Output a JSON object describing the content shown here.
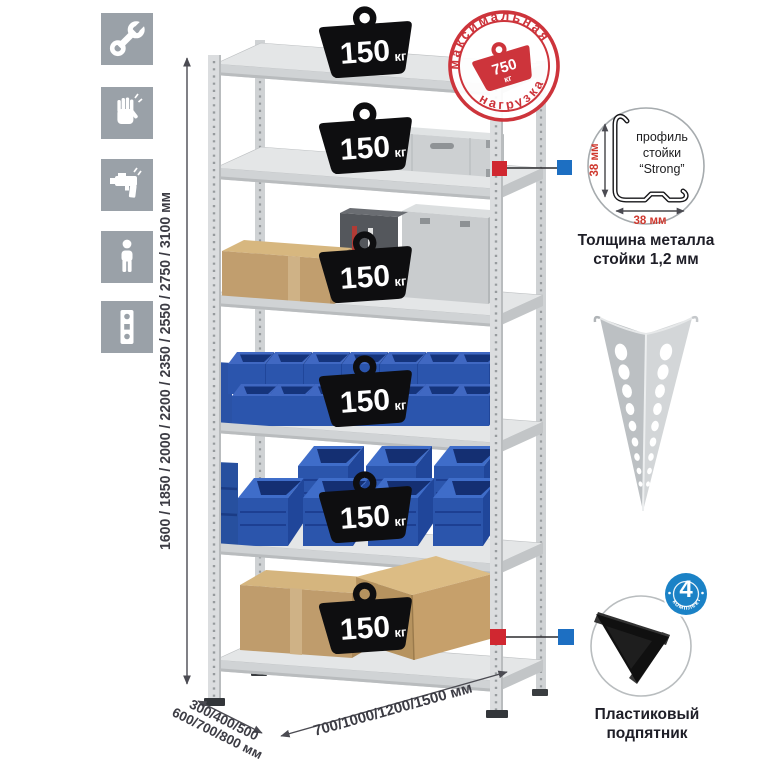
{
  "icons": [
    {
      "name": "wrench-icon"
    },
    {
      "name": "gloves-icon"
    },
    {
      "name": "drill-icon"
    },
    {
      "name": "person-icon"
    },
    {
      "name": "perforated-post-icon"
    }
  ],
  "dimensions": {
    "height": "1600 / 1850 / 2000 / 2200 / 2350 / 2550 / 2750 / 3100 мм",
    "depth_line1": "300/400/500",
    "depth_line2": "600/700/800 мм",
    "width": "700/1000/1200/1500 мм"
  },
  "stamp": {
    "arc_top": "максимальная",
    "arc_bottom": "нагрузка",
    "value": "750",
    "unit": "кг"
  },
  "rack": {
    "shelves": [
      {
        "load": "150",
        "unit": "кг"
      },
      {
        "load": "150",
        "unit": "кг"
      },
      {
        "load": "150",
        "unit": "кг"
      },
      {
        "load": "150",
        "unit": "кг"
      },
      {
        "load": "150",
        "unit": "кг"
      },
      {
        "load": "150",
        "unit": "кг"
      }
    ]
  },
  "profile_detail": {
    "line1": "профиль",
    "line2": "стойки",
    "line3": "“Strong”",
    "vertical_dim": "38 мм",
    "horizontal_dim": "38 мм",
    "caption_line1": "Толщина металла",
    "caption_line2": "стойки 1,2 мм"
  },
  "foot_detail": {
    "badge_value": "4",
    "badge_arc": "в комплекте",
    "caption_line1": "Пластиковый",
    "caption_line2": "подпятник"
  },
  "colors": {
    "stamp_red": "#cd343b",
    "marker_red": "#d02730",
    "marker_blue": "#1d6fc2",
    "bin_blue": "#2b55ad",
    "icon_grey": "#9aa1a8",
    "dim_red": "#cf382e"
  }
}
